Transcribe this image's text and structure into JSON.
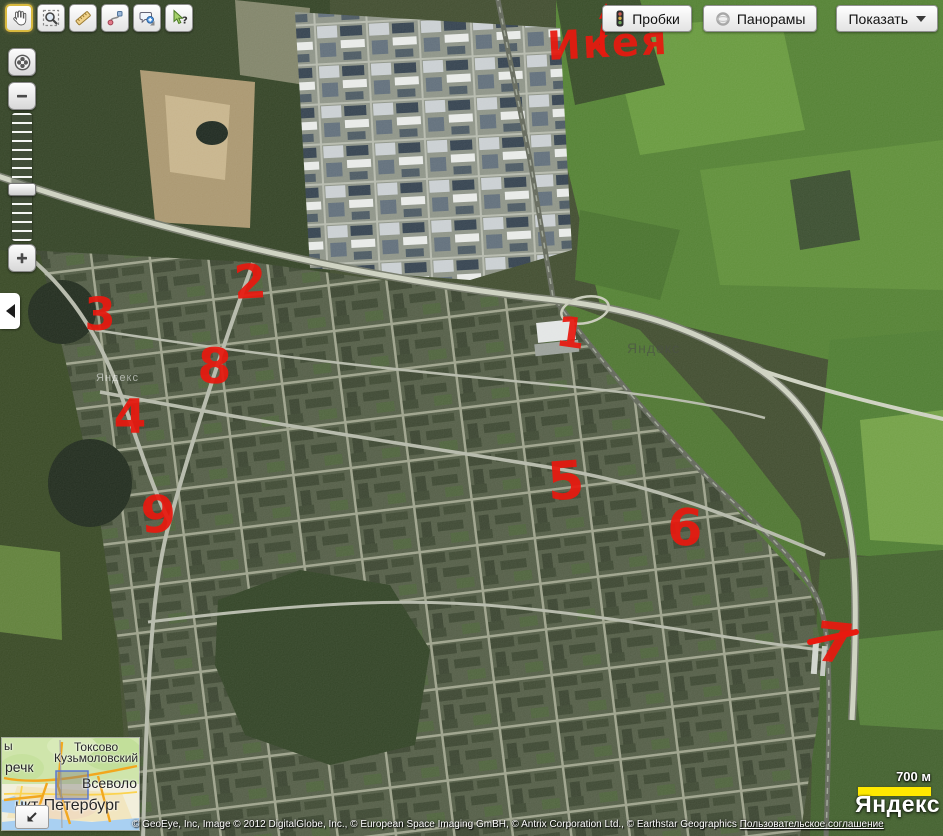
{
  "window": {
    "width": 943,
    "height": 836
  },
  "toolbar": {
    "buttons": [
      {
        "name": "pan-hand",
        "icon": "hand-icon",
        "selected": true
      },
      {
        "name": "magnifier-zoom",
        "icon": "magnifier-icon",
        "selected": false
      },
      {
        "name": "ruler-measure",
        "icon": "ruler-icon",
        "selected": false
      },
      {
        "name": "route",
        "icon": "route-icon",
        "selected": false
      },
      {
        "name": "add-placemark-comment",
        "icon": "comment-plus-icon",
        "selected": false
      },
      {
        "name": "whats-here-help",
        "icon": "cursor-question-icon",
        "selected": false
      }
    ]
  },
  "top_buttons": {
    "traffic_label": "Пробки",
    "panoramas_label": "Панорамы",
    "show_label": "Показать"
  },
  "zoom_control": {
    "buttons": [
      "zoom-to-extent",
      "zoom-out-minus",
      "zoom-slider",
      "zoom-in-plus"
    ],
    "zoom_out_symbol": "−",
    "zoom_in_symbol": "+"
  },
  "annotations": {
    "color": "#e8190f",
    "items": [
      {
        "id": "ikea-word",
        "label": "Икея",
        "x": 548,
        "y": 60,
        "size": 40,
        "rotate": -3,
        "anchor": "start",
        "spacing": 2
      },
      {
        "id": "1",
        "label": "1",
        "x": 569,
        "y": 347,
        "size": 42,
        "rotate": 8
      },
      {
        "id": "2",
        "label": "2",
        "x": 251,
        "y": 298,
        "size": 47,
        "rotate": -3
      },
      {
        "id": "3",
        "label": "3",
        "x": 100,
        "y": 330,
        "size": 45,
        "rotate": 0
      },
      {
        "id": "8",
        "label": "8",
        "x": 214,
        "y": 383,
        "size": 49,
        "rotate": 2
      },
      {
        "id": "4",
        "label": "4",
        "x": 130,
        "y": 433,
        "size": 47,
        "rotate": 0
      },
      {
        "id": "9",
        "label": "9",
        "x": 159,
        "y": 532,
        "size": 51,
        "rotate": -2
      },
      {
        "id": "5",
        "label": "5",
        "x": 567,
        "y": 499,
        "size": 53,
        "rotate": -4
      },
      {
        "id": "6",
        "label": "6",
        "x": 684,
        "y": 545,
        "size": 51,
        "rotate": 3
      },
      {
        "id": "7",
        "label": "7",
        "x": 833,
        "y": 662,
        "size": 55,
        "rotate": 6
      },
      {
        "id": "7-cross",
        "type": "stroke",
        "d": "M 810,642 L 856,632",
        "width": 6
      }
    ],
    "arrow": {
      "from_x": 603,
      "from_y": 52,
      "to_x": 607,
      "to_y": 12
    }
  },
  "watermarks": [
    {
      "text": "Яндекс",
      "x": 96,
      "y": 372,
      "size": 11,
      "color": "rgba(255,255,255,0.55)"
    },
    {
      "text": "Яндекс",
      "x": 627,
      "y": 340,
      "size": 14,
      "color": "rgba(75,80,72,0.65)"
    }
  ],
  "minimap": {
    "labels": [
      {
        "text": "ы",
        "x": 2,
        "y": 1,
        "size": 12
      },
      {
        "text": "Токсово",
        "x": 72,
        "y": 2,
        "size": 12
      },
      {
        "text": "Кузьмоловский",
        "x": 52,
        "y": 13,
        "size": 12
      },
      {
        "text": "речк",
        "x": 3,
        "y": 21,
        "size": 14
      },
      {
        "text": "Всеволо",
        "x": 80,
        "y": 37,
        "size": 14
      },
      {
        "text": "нкт-Петербург",
        "x": 13,
        "y": 59,
        "size": 16
      }
    ],
    "collapse_icon": "arrow-down-left-icon"
  },
  "scale_bar": {
    "label": "700 м"
  },
  "logo": {
    "text": "Яндекс"
  },
  "attribution": {
    "text": "© GeoEye, Inc, Image © 2012 DigitalGlobe, Inc., © European Space Imaging GmBH, © Antrix Corporation Ltd., © Earthstar Geographics",
    "link": "Пользовательское соглашение"
  }
}
